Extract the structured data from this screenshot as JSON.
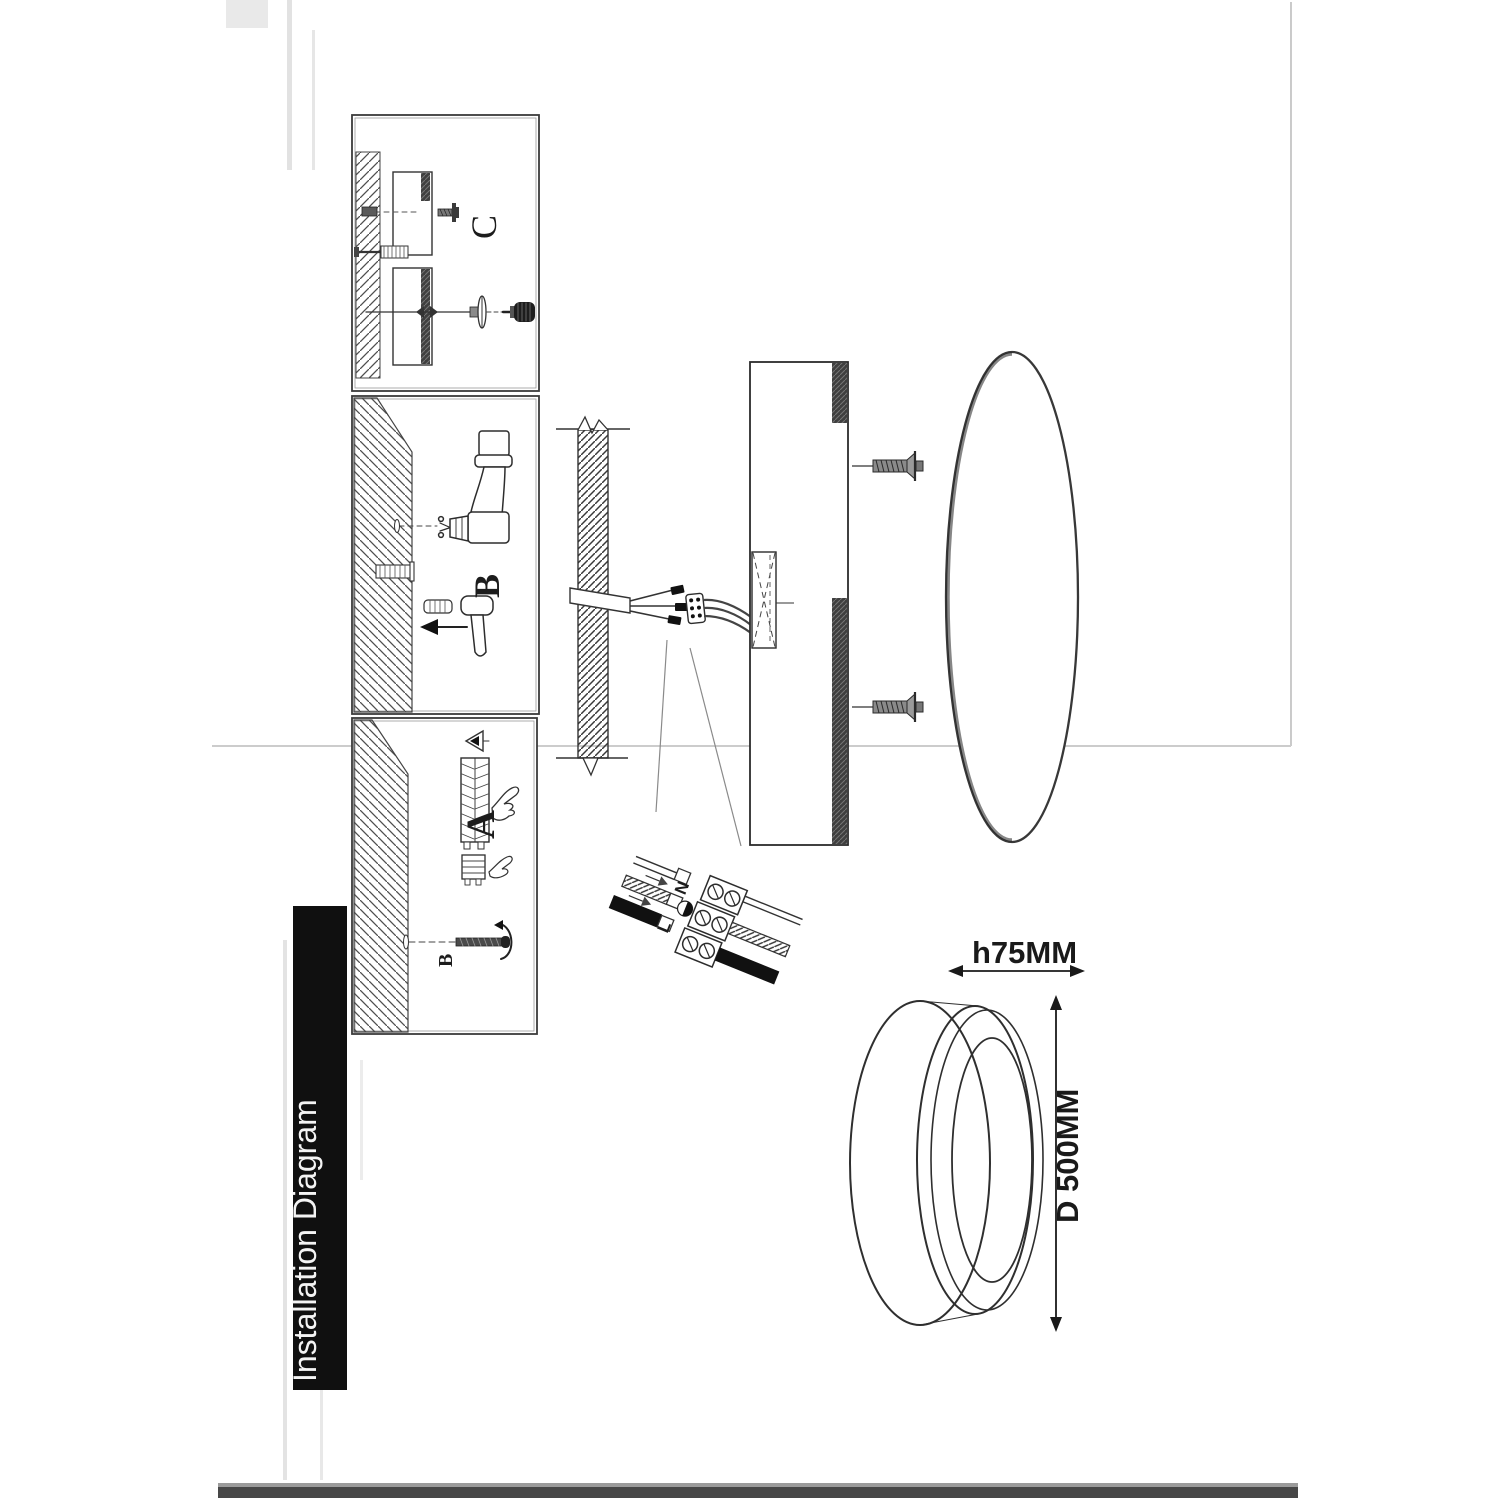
{
  "banner": {
    "label": "Installation Diagram"
  },
  "panels": {
    "step_c": {
      "letter": "C"
    },
    "step_b": {
      "letter": "B"
    },
    "step_a": {
      "letter": "A",
      "screw_label": "B"
    }
  },
  "wiring_detail": {
    "neutral": "N",
    "live": "L",
    "ground_icon": "earth-ground-icon"
  },
  "dimension_labels": {
    "height": "h75MM",
    "diameter": "D 500MM"
  },
  "colors": {
    "ink": "#2b2b2b",
    "banner_bg": "#101010",
    "banner_text": "#f4f4f4",
    "paper": "#ffffff",
    "fold_line": "#cccccc",
    "scan_edge": "#474747"
  }
}
